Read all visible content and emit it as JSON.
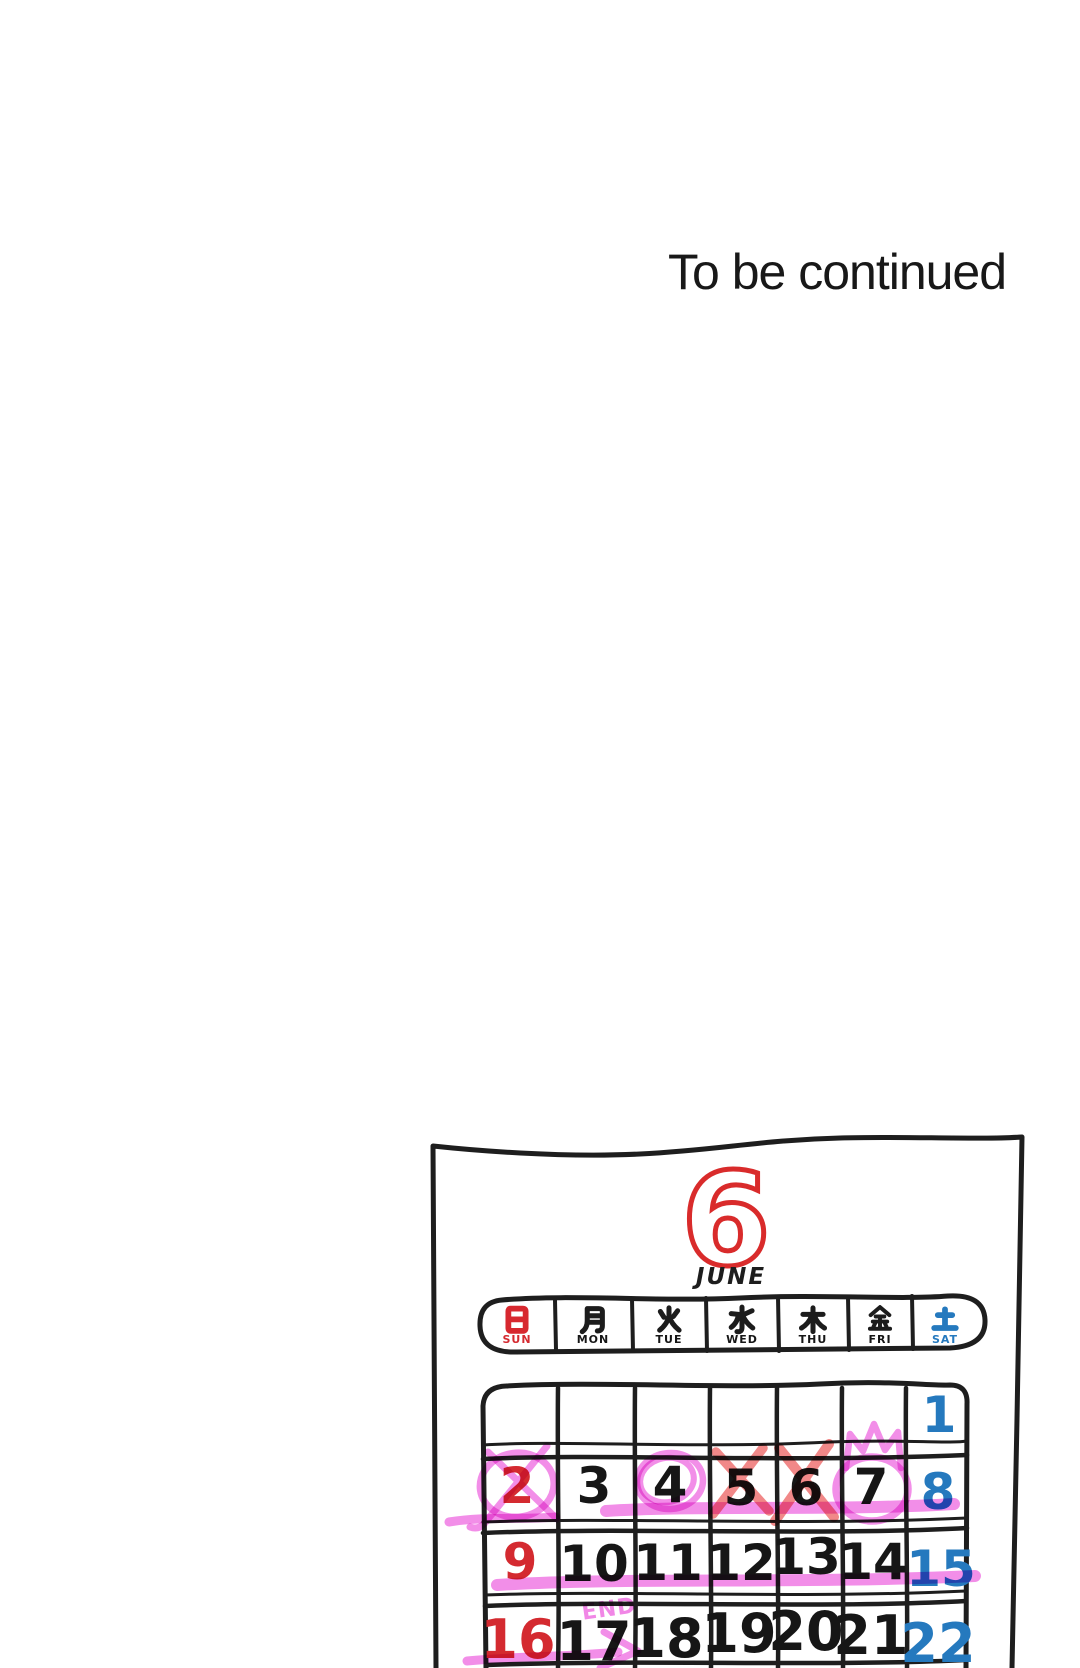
{
  "page": {
    "continue_text": "To be continued"
  },
  "calendar": {
    "month_number": "6",
    "month_name": "JUNE",
    "day_headers": [
      {
        "kanji": "日",
        "en": "SUN",
        "color": "#d7282f"
      },
      {
        "kanji": "月",
        "en": "MON",
        "color": "#1c1c1c"
      },
      {
        "kanji": "火",
        "en": "TUE",
        "color": "#1c1c1c"
      },
      {
        "kanji": "水",
        "en": "WED",
        "color": "#1c1c1c"
      },
      {
        "kanji": "木",
        "en": "THU",
        "color": "#1c1c1c"
      },
      {
        "kanji": "金",
        "en": "FRI",
        "color": "#1c1c1c"
      },
      {
        "kanji": "土",
        "en": "SAT",
        "color": "#2579be"
      }
    ],
    "weeks": [
      {
        "days": [
          "",
          "",
          "",
          "",
          "",
          "",
          "1"
        ]
      },
      {
        "days": [
          "2",
          "3",
          "4",
          "5",
          "6",
          "7",
          "8"
        ]
      },
      {
        "days": [
          "9",
          "10",
          "11",
          "12",
          "13",
          "14",
          "15"
        ]
      },
      {
        "days": [
          "16",
          "17",
          "18",
          "19",
          "20",
          "21",
          "22"
        ]
      }
    ],
    "colors": {
      "sunday_red": "#d42a30",
      "weekday_black": "#161616",
      "saturday_blue": "#2579be",
      "month_red": "#d92b2b",
      "marker_pink": "#ef72e2",
      "marker_salmon": "#ee6a6a"
    },
    "annotations": {
      "end_label": "END",
      "pink_circled_days": [
        "2",
        "4",
        "7"
      ],
      "pink_crossed_days": [
        "2"
      ],
      "red_crossed_days": [
        "5",
        "6"
      ],
      "crowned_day": "7",
      "pink_underlined_ranges": [
        "4-8",
        "9-15"
      ],
      "arrow_under_days": [
        "16",
        "17"
      ]
    }
  }
}
